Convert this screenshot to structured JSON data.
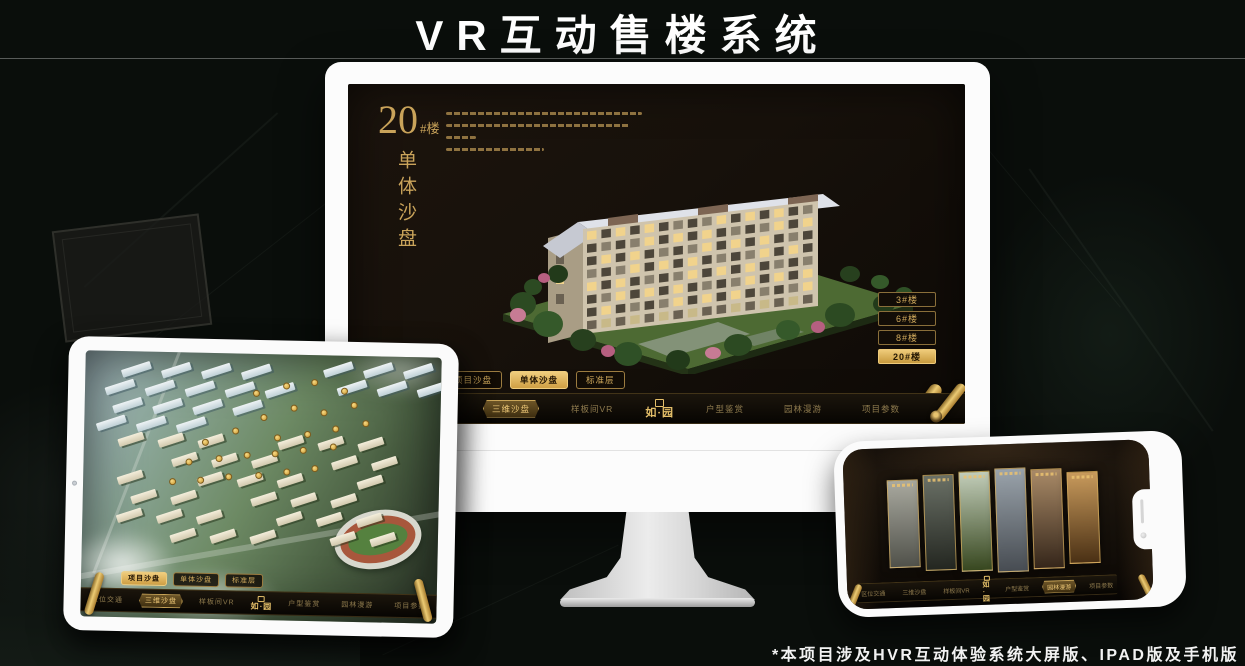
{
  "page": {
    "title": "VR互动售楼系统",
    "footnote": "*本项目涉及HVR互动体验系统大屏版、IPAD版及手机版"
  },
  "colors": {
    "gold": "#c9a558",
    "gold_bright": "#ecc877",
    "screen_bg": "#17110b",
    "frame_white": "#fbfbfb"
  },
  "monitor": {
    "building_no": "20",
    "building_no_suffix": "#楼",
    "building_subtitle": "单体沙盘",
    "floor_buttons": [
      {
        "label": "3#楼",
        "active": false
      },
      {
        "label": "6#楼",
        "active": false
      },
      {
        "label": "8#楼",
        "active": false
      },
      {
        "label": "20#楼",
        "active": true
      }
    ],
    "sub_tabs": [
      {
        "label": "项目沙盘",
        "active": false
      },
      {
        "label": "单体沙盘",
        "active": true
      },
      {
        "label": "标准层",
        "active": false
      }
    ],
    "nav_left": [
      {
        "label": "区位交通",
        "active": false
      },
      {
        "label": "三维沙盘",
        "active": true
      },
      {
        "label": "样板间VR",
        "active": false
      }
    ],
    "nav_logo": "如·园",
    "nav_right": [
      {
        "label": "户型鉴赏",
        "active": false
      },
      {
        "label": "园林漫游",
        "active": false
      },
      {
        "label": "项目参数",
        "active": false
      }
    ]
  },
  "tablet": {
    "sub_tabs": [
      {
        "label": "项目沙盘",
        "active": true
      },
      {
        "label": "单体沙盘",
        "active": false
      },
      {
        "label": "标准层",
        "active": false
      }
    ],
    "nav_left": [
      {
        "label": "区位交通",
        "active": false
      },
      {
        "label": "三维沙盘",
        "active": true
      },
      {
        "label": "样板间VR",
        "active": false
      }
    ],
    "nav_logo": "如·园",
    "nav_right": [
      {
        "label": "户型鉴赏",
        "active": false
      },
      {
        "label": "园林漫游",
        "active": false
      },
      {
        "label": "项目参数",
        "active": false
      }
    ]
  },
  "phone": {
    "nav_left": [
      {
        "label": "区位交通",
        "active": false
      },
      {
        "label": "三维沙盘",
        "active": false
      },
      {
        "label": "样板间VR",
        "active": false
      }
    ],
    "nav_logo": "如·园",
    "nav_right": [
      {
        "label": "户型鉴赏",
        "active": false
      },
      {
        "label": "园林漫游",
        "active": true
      },
      {
        "label": "项目参数",
        "active": false
      }
    ],
    "gallery_panels": [
      {
        "name": "courtyard",
        "c1": "#a9a99f",
        "c2": "#50514a"
      },
      {
        "name": "interior-dark",
        "c1": "#6a7066",
        "c2": "#232620"
      },
      {
        "name": "garden",
        "c1": "#c2cdb9",
        "c2": "#37471f"
      },
      {
        "name": "facade",
        "c1": "#9aa3ab",
        "c2": "#474c52"
      },
      {
        "name": "autumn",
        "c1": "#a98a67",
        "c2": "#35261a"
      },
      {
        "name": "interior-warm",
        "c1": "#c89a5c",
        "c2": "#4a3014"
      }
    ]
  }
}
